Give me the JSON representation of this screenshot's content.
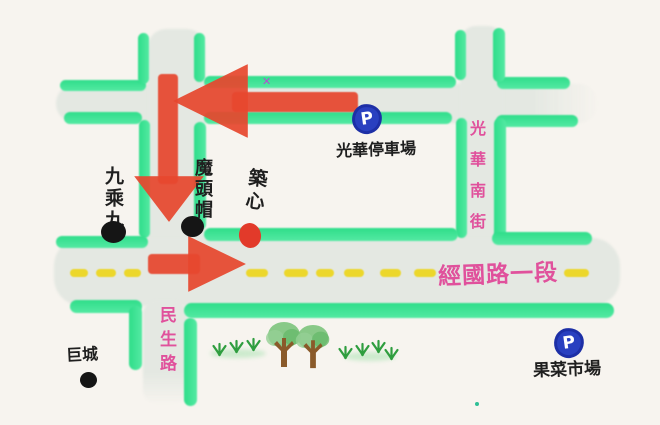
{
  "streets": {
    "jingguo": {
      "label": "經國路一段"
    },
    "minsheng": {
      "label": "民生路"
    },
    "guanghua_south": {
      "label": "光華南街"
    }
  },
  "pois": {
    "guanghua_parking": {
      "label": "光華停車場",
      "icon": "P"
    },
    "fruit_market": {
      "label": "果菜市場",
      "icon": "P"
    },
    "nine_x_nine": {
      "label": "九乘九"
    },
    "motou_hat": {
      "label": "魔頭帽"
    },
    "zhu_xin": {
      "label": "築心"
    },
    "ju_cheng": {
      "label": "巨城"
    }
  },
  "marks": {
    "x_mark": "✕"
  },
  "colors": {
    "background": "#f7f4ef",
    "road_fill": "#e4e8e2",
    "road_edge": "#3ce394",
    "arrow_red": "#e7472f",
    "center_line_yellow": "#ecd72b",
    "street_label_pink": "#e0519c",
    "poi_text_black": "#1f1f1f",
    "parking_blue": "#2940c0",
    "dot_black": "#151515",
    "dot_red": "#e23a2a",
    "x_mark_purple": "#b34fd0"
  }
}
